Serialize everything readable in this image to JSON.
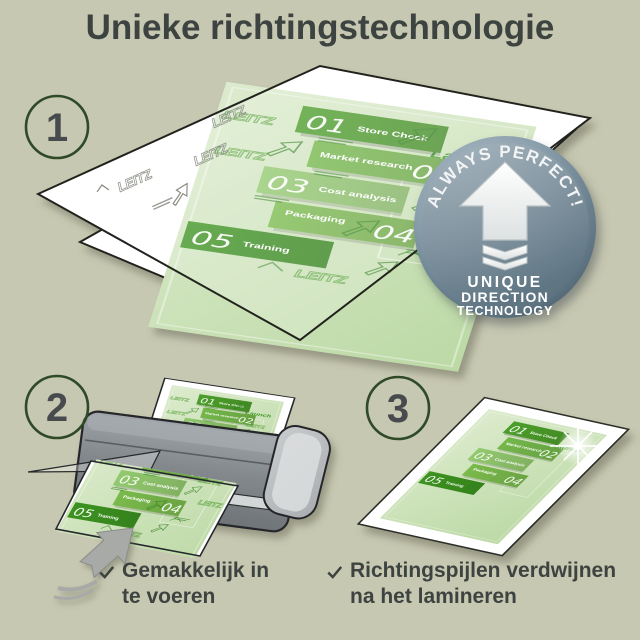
{
  "title": "Unieke richtingstechnologie",
  "steps": {
    "s1": "1",
    "s2": "2",
    "s3": "3"
  },
  "badge": {
    "arc": "ALWAYS PERFECT!",
    "line1": "UNIQUE",
    "line2": "DIRECTION",
    "line3": "TECHNOLOGY"
  },
  "doc": {
    "launch": "Launch",
    "watermark": "LEITZ",
    "items": [
      {
        "num": "01",
        "label": "Store Check"
      },
      {
        "num": "02",
        "label": "Market research"
      },
      {
        "num": "03",
        "label": "Cost analysis"
      },
      {
        "num": "04",
        "label": "Packaging"
      },
      {
        "num": "05",
        "label": "Training"
      }
    ]
  },
  "checklist": [
    {
      "line1": "Gemakkelijk in",
      "line2": "te voeren"
    },
    {
      "line1": "Richtingspijlen verdwijnen",
      "line2": "na het lamineren"
    }
  ],
  "colors": {
    "background": "#c7c8b1",
    "text": "#3d4340",
    "accent_green": "#4c9e2a",
    "band_greens": [
      "#4c9e2a",
      "#74b74a",
      "#92c96e",
      "#7aba4c",
      "#3c9320"
    ],
    "badge_steel": "#7b909d",
    "step_circle_stroke": "#2e4a26",
    "machine_grey": "#84898d"
  }
}
